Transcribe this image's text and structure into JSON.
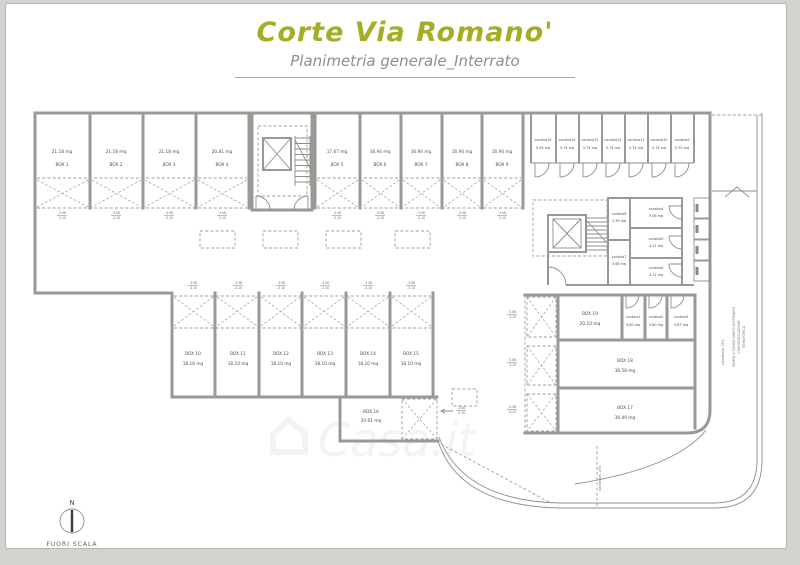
{
  "header": {
    "title": "Corte Via Romano'",
    "subtitle": "Planimetria generale_Interrato",
    "title_color": "#a4ae25",
    "subtitle_color": "#8e8e8e"
  },
  "plan": {
    "boxes": [
      {
        "name": "BOX 1",
        "area": "21.18 mq"
      },
      {
        "name": "BOX 2",
        "area": "21.18 mq"
      },
      {
        "name": "BOX 3",
        "area": "21.18 mq"
      },
      {
        "name": "BOX 4",
        "area": "20.81 mq"
      },
      {
        "name": "BOX 5",
        "area": "17.67 mq"
      },
      {
        "name": "BOX 6",
        "area": "16.94 mq"
      },
      {
        "name": "BOX 7",
        "area": "16.94 mq"
      },
      {
        "name": "BOX 8",
        "area": "16.94 mq"
      },
      {
        "name": "BOX 9",
        "area": "16.94 mq"
      },
      {
        "name": "BOX 10",
        "area": "18.16 mq"
      },
      {
        "name": "BOX 11",
        "area": "18.10 mq"
      },
      {
        "name": "BOX 12",
        "area": "18.10 mq"
      },
      {
        "name": "BOX 13",
        "area": "18.10 mq"
      },
      {
        "name": "BOX 14",
        "area": "18.10 mq"
      },
      {
        "name": "BOX 15",
        "area": "18.10 mq"
      },
      {
        "name": "BOX 16",
        "area": "20.61 mq"
      },
      {
        "name": "BOX 17",
        "area": "36.49 mq"
      },
      {
        "name": "BOX 18",
        "area": "36.58 mq"
      },
      {
        "name": "BOX 19",
        "area": "20.10 mq"
      }
    ],
    "cantinas": [
      {
        "name": "cantina1",
        "area": "4.80 mq"
      },
      {
        "name": "cantina2",
        "area": "4.80 mq"
      },
      {
        "name": "cantina3",
        "area": "4.87 mq"
      },
      {
        "name": "cantina4",
        "area": "9.06 mq"
      },
      {
        "name": "cantina5",
        "area": "4.11 mq"
      },
      {
        "name": "cantina6",
        "area": "4.11 mq"
      },
      {
        "name": "cantina7",
        "area": "3.68 mq"
      },
      {
        "name": "cantina8",
        "area": "3.39 mq"
      },
      {
        "name": "cantina9",
        "area": "5.70 mq"
      },
      {
        "name": "cantina10",
        "area": "5.74 mq"
      },
      {
        "name": "cantina11",
        "area": "5.74 mq"
      },
      {
        "name": "cantina12",
        "area": "5.74 mq"
      },
      {
        "name": "cantina13",
        "area": "5.74 mq"
      },
      {
        "name": "cantina14",
        "area": "5.74 mq"
      },
      {
        "name": "cantina15",
        "area": "9.26 mq"
      }
    ],
    "levels": {
      "upper": "-3.08",
      "lower": "-3.10"
    },
    "ramp": {
      "label_line1": "RAMPA A SENSO UNICO ALTERNATO",
      "label_line2": "CON REGOLAZIONE",
      "label_line3": "SEMAFORICA",
      "slope": "pendenza 15%"
    },
    "compass": {
      "north": "N",
      "caption": "FUORI SCALA"
    }
  },
  "watermark": "Casa.it"
}
